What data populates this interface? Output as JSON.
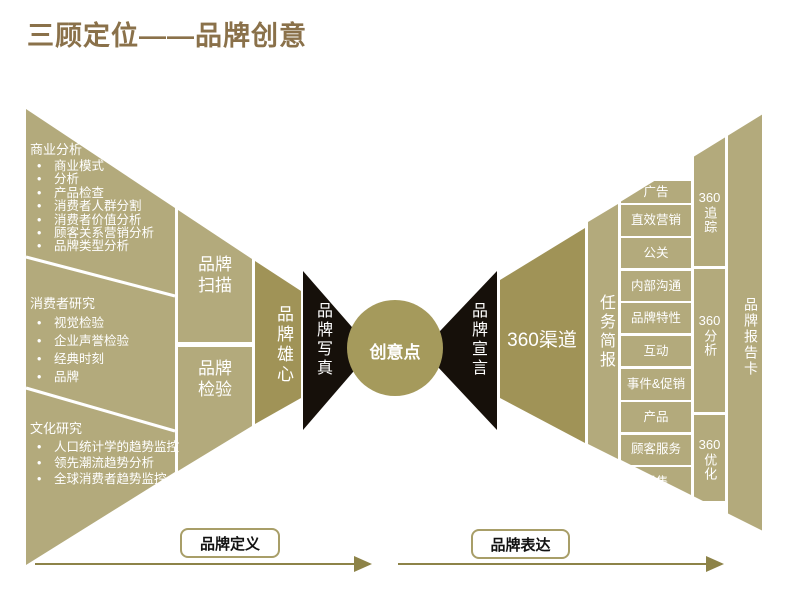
{
  "title": "三顾定位——品牌创意",
  "colors": {
    "light_olive": "#b3aa7c",
    "dark_olive": "#a09357",
    "black_shape": "#16100a",
    "title_text": "#8a714a",
    "arrow": "#8d8348",
    "label_border": "#a89e68"
  },
  "funnel": {
    "sections": [
      {
        "header": "商业分析",
        "items": [
          "商业模式",
          "分析",
          "产品检查",
          "消费者人群分割",
          "消费者价值分析",
          "顾客关系营销分析",
          "品牌类型分析"
        ]
      },
      {
        "header": "消费者研究",
        "items": [
          "视觉检验",
          "企业声誉检验",
          "经典时刻",
          "品牌"
        ]
      },
      {
        "header": "文化研究",
        "items": [
          "人口统计学的趋势监控",
          "领先潮流趋势分析",
          "全球消费者趋势监控"
        ]
      }
    ]
  },
  "stages": {
    "brand_scan": "品牌扫描",
    "brand_check": "品牌检验",
    "brand_ambition": "品牌雄心",
    "brand_portrait": "品牌写真",
    "idea_point": "创意点",
    "brand_manifesto": "品牌宣言",
    "channels_360": "360渠道",
    "task_brief": "任务简报",
    "brand_report_card": "品牌报告卡"
  },
  "channel_boxes": [
    "广告",
    "直效营销",
    "公关",
    "内部沟通",
    "品牌特性",
    "互动",
    "事件&促销",
    "产品",
    "顾客服务",
    "零售"
  ],
  "loop_360": [
    {
      "num": "360",
      "label": "追踪"
    },
    {
      "num": "360",
      "label": "分析"
    },
    {
      "num": "360",
      "label": "优化"
    }
  ],
  "bottom": {
    "left_arrow_label": "品牌定义",
    "right_arrow_label": "品牌表达"
  }
}
